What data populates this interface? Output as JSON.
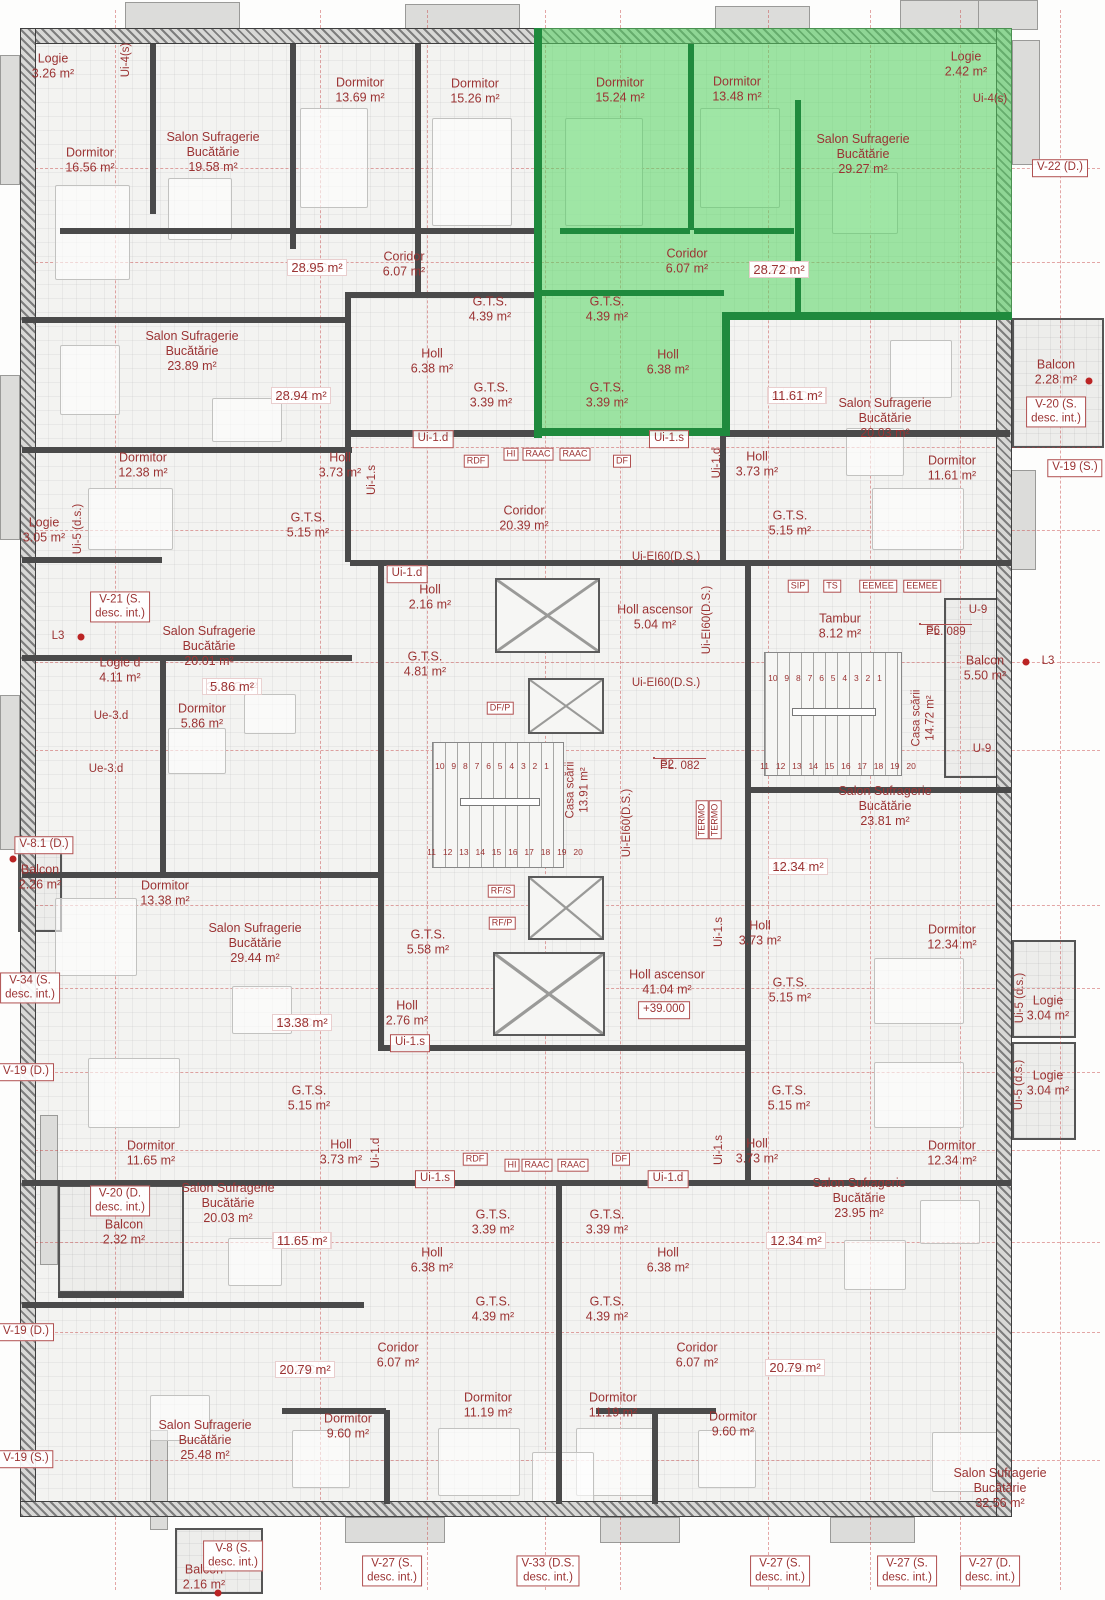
{
  "plan": {
    "highlighted_apartment": "Ap. 81",
    "level_mark": "+39.000",
    "colors": {
      "label_red": "#9b3333",
      "highlight_green": "#54d660",
      "wall_dark": "#4a4a4a",
      "green_wall": "#1f8a3d"
    }
  },
  "apartments": [
    {
      "id": "Ap. 80",
      "total": "72.02 m²",
      "type": "2-C",
      "area2": "28.95 m²",
      "x": 317,
      "y": 259
    },
    {
      "id": "Ap. 81",
      "total": "80.64 m²",
      "type": "2-C",
      "area2": "28.72 m²",
      "x": 779,
      "y": 261
    },
    {
      "id": "Ap. 82",
      "total": "41.20 m²",
      "type": "1-C",
      "area2": "11.61 m²",
      "x": 797,
      "y": 387
    },
    {
      "id": "Ap. 79",
      "total": "64.76 m²",
      "type": "2-C",
      "area2": "28.94 m²",
      "x": 301,
      "y": 387
    },
    {
      "id": "Ap. 78",
      "total": "34.89 m²",
      "type": "1-C",
      "area2": "5.86 m²",
      "x": 232,
      "y": 678
    },
    {
      "id": "Ap. 83",
      "total": "48.07 m²",
      "type": "1-C",
      "area2": "12.34 m²",
      "x": 798,
      "y": 858
    },
    {
      "id": "Ap. 88",
      "total": "51.83 m²",
      "type": "1-C",
      "area2": "13.38 m²",
      "x": 302,
      "y": 1014
    },
    {
      "id": "Ap. 87",
      "total": "41.25 m²",
      "type": "1-C",
      "area2": "11.65 m²",
      "x": 302,
      "y": 1232
    },
    {
      "id": "Ap. 84",
      "total": "48.21 m²",
      "type": "1-C",
      "area2": "12.34 m²",
      "x": 796,
      "y": 1232
    },
    {
      "id": "Ap. 86",
      "total": "67.15 m²",
      "type": "2-C",
      "area2": "20.79 m²",
      "x": 305,
      "y": 1361
    },
    {
      "id": "Ap. 85",
      "total": "73.58 m²",
      "type": "2-C",
      "area2": "20.79 m²",
      "x": 795,
      "y": 1359
    }
  ],
  "rooms": [
    {
      "t": [
        "Logie",
        "3.26 m²"
      ],
      "x": 53,
      "y": 66
    },
    {
      "t": [
        "Dormitor",
        "16.56 m²"
      ],
      "x": 90,
      "y": 160
    },
    {
      "t": [
        "Salon Sufragerie",
        "Bucătărie",
        "19.58 m²"
      ],
      "x": 213,
      "y": 152
    },
    {
      "t": [
        "Dormitor",
        "13.69 m²"
      ],
      "x": 360,
      "y": 90
    },
    {
      "t": [
        "Coridor",
        "6.07 m²"
      ],
      "x": 404,
      "y": 264
    },
    {
      "t": [
        "Dormitor",
        "15.26 m²"
      ],
      "x": 475,
      "y": 91
    },
    {
      "t": [
        "G.T.S.",
        "4.39 m²"
      ],
      "x": 490,
      "y": 309
    },
    {
      "t": [
        "Holl",
        "6.38 m²"
      ],
      "x": 432,
      "y": 361
    },
    {
      "t": [
        "G.T.S.",
        "3.39 m²"
      ],
      "x": 491,
      "y": 395
    },
    {
      "t": [
        "Dormitor",
        "15.24 m²"
      ],
      "x": 620,
      "y": 90
    },
    {
      "t": [
        "Dormitor",
        "13.48 m²"
      ],
      "x": 737,
      "y": 89
    },
    {
      "t": [
        "Logie",
        "2.42 m²"
      ],
      "x": 966,
      "y": 64
    },
    {
      "t": [
        "Salon Sufragerie",
        "Bucătărie",
        "29.27 m²"
      ],
      "x": 863,
      "y": 154
    },
    {
      "t": [
        "Coridor",
        "6.07 m²"
      ],
      "x": 687,
      "y": 261
    },
    {
      "t": [
        "G.T.S.",
        "4.39 m²"
      ],
      "x": 607,
      "y": 309
    },
    {
      "t": [
        "G.T.S.",
        "3.39 m²"
      ],
      "x": 607,
      "y": 395
    },
    {
      "t": [
        "Holl",
        "6.38 m²"
      ],
      "x": 668,
      "y": 362
    },
    {
      "t": [
        "Salon Sufragerie",
        "Bucătărie",
        "20.03 m²"
      ],
      "x": 885,
      "y": 418
    },
    {
      "t": [
        "Balcon",
        "2.28 m²"
      ],
      "x": 1056,
      "y": 372
    },
    {
      "t": [
        "Holl",
        "3.73 m²"
      ],
      "x": 757,
      "y": 464
    },
    {
      "t": [
        "Dormitor",
        "11.61 m²"
      ],
      "x": 952,
      "y": 468
    },
    {
      "t": [
        "G.T.S.",
        "5.15 m²"
      ],
      "x": 790,
      "y": 523
    },
    {
      "t": [
        "Salon Sufragerie",
        "Bucătărie",
        "23.89 m²"
      ],
      "x": 192,
      "y": 351
    },
    {
      "t": [
        "Dormitor",
        "12.38 m²"
      ],
      "x": 143,
      "y": 465
    },
    {
      "t": [
        "Holl",
        "3.73 m²"
      ],
      "x": 340,
      "y": 465
    },
    {
      "t": [
        "Logie",
        "3.05 m²"
      ],
      "x": 44,
      "y": 530
    },
    {
      "t": [
        "G.T.S.",
        "5.15 m²"
      ],
      "x": 308,
      "y": 525
    },
    {
      "t": [
        "Coridor",
        "20.39 m²"
      ],
      "x": 524,
      "y": 518
    },
    {
      "t": [
        "Holl ascensor",
        "5.04 m²"
      ],
      "x": 655,
      "y": 617
    },
    {
      "t": [
        "Holl",
        "2.16 m²"
      ],
      "x": 430,
      "y": 597
    },
    {
      "t": [
        "G.T.S.",
        "4.81 m²"
      ],
      "x": 425,
      "y": 664
    },
    {
      "t": [
        "Tambur",
        "8.12 m²"
      ],
      "x": 840,
      "y": 626
    },
    {
      "t": [
        "Balcon",
        "5.50 m²"
      ],
      "x": 985,
      "y": 668
    },
    {
      "t": [
        "Logie d",
        "4.11 m²"
      ],
      "x": 120,
      "y": 670
    },
    {
      "t": [
        "Salon Sufragerie",
        "Bucătărie",
        "20.01 m²"
      ],
      "x": 209,
      "y": 646
    },
    {
      "t": [
        "Dormitor",
        "5.86 m²"
      ],
      "x": 202,
      "y": 716
    },
    {
      "t": [
        "Balcon",
        "2.26 m²"
      ],
      "x": 40,
      "y": 877
    },
    {
      "t": [
        "Dormitor",
        "13.38 m²"
      ],
      "x": 165,
      "y": 893
    },
    {
      "t": [
        "Salon Sufragerie",
        "Bucătărie",
        "29.44 m²"
      ],
      "x": 255,
      "y": 943
    },
    {
      "t": [
        "Dormitor",
        "11.65 m²"
      ],
      "x": 151,
      "y": 1153
    },
    {
      "t": [
        "G.T.S.",
        "5.15 m²"
      ],
      "x": 309,
      "y": 1098
    },
    {
      "t": [
        "Holl",
        "3.73 m²"
      ],
      "x": 341,
      "y": 1152
    },
    {
      "t": [
        "G.T.S.",
        "5.58 m²"
      ],
      "x": 428,
      "y": 942
    },
    {
      "t": [
        "Holl",
        "2.76 m²"
      ],
      "x": 407,
      "y": 1013
    },
    {
      "t": [
        "Holl ascensor",
        "41.04 m²"
      ],
      "x": 667,
      "y": 982
    },
    {
      "t": [
        "Salon Sufragerie",
        "Bucătărie",
        "23.81 m²"
      ],
      "x": 885,
      "y": 806
    },
    {
      "t": [
        "Dormitor",
        "12.34 m²"
      ],
      "x": 952,
      "y": 937
    },
    {
      "t": [
        "Logie",
        "3.04 m²"
      ],
      "x": 1048,
      "y": 1008
    },
    {
      "t": [
        "Holl",
        "3.73 m²"
      ],
      "x": 760,
      "y": 933
    },
    {
      "t": [
        "G.T.S.",
        "5.15 m²"
      ],
      "x": 790,
      "y": 990
    },
    {
      "t": [
        "G.T.S.",
        "5.15 m²"
      ],
      "x": 789,
      "y": 1098
    },
    {
      "t": [
        "Holl",
        "3.73 m²"
      ],
      "x": 757,
      "y": 1151
    },
    {
      "t": [
        "Dormitor",
        "12.34 m²"
      ],
      "x": 952,
      "y": 1153
    },
    {
      "t": [
        "Logie",
        "3.04 m²"
      ],
      "x": 1048,
      "y": 1083
    },
    {
      "t": [
        "Salon Sufragerie",
        "Bucătărie",
        "23.95 m²"
      ],
      "x": 859,
      "y": 1198
    },
    {
      "t": [
        "Balcon",
        "2.32 m²"
      ],
      "x": 124,
      "y": 1232
    },
    {
      "t": [
        "Salon Sufragerie",
        "Bucătărie",
        "20.03 m²"
      ],
      "x": 228,
      "y": 1203
    },
    {
      "t": [
        "Salon Sufragerie",
        "Bucătărie",
        "25.48 m²"
      ],
      "x": 205,
      "y": 1440
    },
    {
      "t": [
        "Dormitor",
        "9.60 m²"
      ],
      "x": 348,
      "y": 1426
    },
    {
      "t": [
        "G.T.S.",
        "3.39 m²"
      ],
      "x": 493,
      "y": 1222
    },
    {
      "t": [
        "G.T.S.",
        "3.39 m²"
      ],
      "x": 607,
      "y": 1222
    },
    {
      "t": [
        "Holl",
        "6.38 m²"
      ],
      "x": 432,
      "y": 1260
    },
    {
      "t": [
        "Holl",
        "6.38 m²"
      ],
      "x": 668,
      "y": 1260
    },
    {
      "t": [
        "G.T.S.",
        "4.39 m²"
      ],
      "x": 493,
      "y": 1309
    },
    {
      "t": [
        "G.T.S.",
        "4.39 m²"
      ],
      "x": 607,
      "y": 1309
    },
    {
      "t": [
        "Coridor",
        "6.07 m²"
      ],
      "x": 398,
      "y": 1355
    },
    {
      "t": [
        "Coridor",
        "6.07 m²"
      ],
      "x": 697,
      "y": 1355
    },
    {
      "t": [
        "Dormitor",
        "11.19 m²"
      ],
      "x": 488,
      "y": 1405
    },
    {
      "t": [
        "Dormitor",
        "11.19 m²"
      ],
      "x": 613,
      "y": 1405
    },
    {
      "t": [
        "Dormitor",
        "9.60 m²"
      ],
      "x": 733,
      "y": 1424
    },
    {
      "t": [
        "Salon Sufragerie",
        "Bucătărie",
        "32.56 m²"
      ],
      "x": 1000,
      "y": 1488
    },
    {
      "t": [
        "Balcon",
        "2.16 m²"
      ],
      "x": 204,
      "y": 1577
    }
  ],
  "boxes": [
    {
      "t": [
        "V-22 (D.)"
      ],
      "x": 1060,
      "y": 168
    },
    {
      "t": [
        "V-20 (S.",
        "desc. int.)"
      ],
      "x": 1056,
      "y": 412
    },
    {
      "t": [
        "V-19 (S.)"
      ],
      "x": 1075,
      "y": 468
    },
    {
      "t": [
        "V-21 (S.",
        "desc. int.)"
      ],
      "x": 120,
      "y": 607
    },
    {
      "t": [
        "V-8.1 (D.)"
      ],
      "x": 44,
      "y": 845
    },
    {
      "t": [
        "V-34 (S.",
        "desc. int.)"
      ],
      "x": 30,
      "y": 988
    },
    {
      "t": [
        "V-19 (D.)"
      ],
      "x": 26,
      "y": 1072
    },
    {
      "t": [
        "V-20 (D.",
        "desc. int.)"
      ],
      "x": 120,
      "y": 1201
    },
    {
      "t": [
        "V-19 (D.)"
      ],
      "x": 26,
      "y": 1332
    },
    {
      "t": [
        "V-19 (S.)"
      ],
      "x": 26,
      "y": 1459
    },
    {
      "t": [
        "+39.000"
      ],
      "x": 664,
      "y": 1010
    },
    {
      "t": [
        "Ui-1.d"
      ],
      "x": 433,
      "y": 439
    },
    {
      "t": [
        "Ui-1.s"
      ],
      "x": 669,
      "y": 439
    },
    {
      "t": [
        "Ui-1.d"
      ],
      "x": 407,
      "y": 574
    },
    {
      "t": [
        "Ui-1.s"
      ],
      "x": 410,
      "y": 1043
    },
    {
      "t": [
        "Ui-1.s"
      ],
      "x": 435,
      "y": 1179
    },
    {
      "t": [
        "Ui-1.d"
      ],
      "x": 668,
      "y": 1179
    },
    {
      "t": [
        "V-8 (S.",
        "desc. int.)"
      ],
      "x": 233,
      "y": 1556
    },
    {
      "t": [
        "V-27 (S.",
        "desc. int.)"
      ],
      "x": 392,
      "y": 1571
    },
    {
      "t": [
        "V-33 (D.S.",
        "desc. int.)"
      ],
      "x": 548,
      "y": 1571
    },
    {
      "t": [
        "V-27 (S.",
        "desc. int.)"
      ],
      "x": 780,
      "y": 1571
    },
    {
      "t": [
        "V-27 (S.",
        "desc. int.)"
      ],
      "x": 907,
      "y": 1571
    },
    {
      "t": [
        "V-27 (D.",
        "desc. int.)"
      ],
      "x": 990,
      "y": 1571
    }
  ],
  "cellboxes": [
    {
      "t": [
        "E2",
        "PL. 082"
      ],
      "x": 654,
      "y": 758
    },
    {
      "t": [
        "E6",
        "PL. 089"
      ],
      "x": 920,
      "y": 624
    }
  ],
  "plain": [
    {
      "t": "Ui-4(s)",
      "x": 990,
      "y": 100
    },
    {
      "t": "Ui-EI60(D.S.)",
      "x": 666,
      "y": 558
    },
    {
      "t": "Ui-EI60(D.S.)",
      "x": 666,
      "y": 684
    },
    {
      "t": "U-9",
      "x": 978,
      "y": 611
    },
    {
      "t": "U-9",
      "x": 982,
      "y": 750
    },
    {
      "t": "L3",
      "x": 1048,
      "y": 662
    },
    {
      "t": "L3",
      "x": 58,
      "y": 637
    },
    {
      "t": "Ue-3.d",
      "x": 111,
      "y": 717
    },
    {
      "t": "Ue-3.d",
      "x": 106,
      "y": 770
    }
  ],
  "vertical": [
    {
      "t": [
        "Ui-4(s)"
      ],
      "x": 127,
      "y": 60
    },
    {
      "t": [
        "Ui-5 (d.s.)"
      ],
      "x": 79,
      "y": 529
    },
    {
      "t": [
        "Ui-1.s"
      ],
      "x": 373,
      "y": 480
    },
    {
      "t": [
        "Ui-1.d"
      ],
      "x": 718,
      "y": 463
    },
    {
      "t": [
        "Ui-EI60(D.S.)"
      ],
      "x": 708,
      "y": 620
    },
    {
      "t": [
        "Ui-EI60(D.S.)"
      ],
      "x": 628,
      "y": 823
    },
    {
      "t": [
        "Ui-1.d"
      ],
      "x": 377,
      "y": 1153
    },
    {
      "t": [
        "Ui-1.s"
      ],
      "x": 720,
      "y": 932
    },
    {
      "t": [
        "Ui-1.s"
      ],
      "x": 720,
      "y": 1150
    },
    {
      "t": [
        "Ui-5 (d.s.)"
      ],
      "x": 1021,
      "y": 998
    },
    {
      "t": [
        "Ui-5 (d.s.)"
      ],
      "x": 1020,
      "y": 1085
    },
    {
      "t": [
        "Casa scării",
        "13.91 m²"
      ],
      "x": 578,
      "y": 790
    },
    {
      "t": [
        "Casa scării",
        "14.72 m²"
      ],
      "x": 924,
      "y": 718
    }
  ],
  "vboxes": [
    {
      "t": "TERMO",
      "x": 702,
      "y": 820
    },
    {
      "t": "TERMO",
      "x": 715,
      "y": 820
    }
  ],
  "small": [
    {
      "t": "SIP",
      "x": 798,
      "y": 586
    },
    {
      "t": "TS",
      "x": 832,
      "y": 586
    },
    {
      "t": "EEMEE",
      "x": 878,
      "y": 586
    },
    {
      "t": "EEMEE",
      "x": 922,
      "y": 586
    },
    {
      "t": "RDF",
      "x": 476,
      "y": 461
    },
    {
      "t": "HI",
      "x": 511,
      "y": 454
    },
    {
      "t": "RAAC",
      "x": 538,
      "y": 454
    },
    {
      "t": "RAAC",
      "x": 575,
      "y": 454
    },
    {
      "t": "DF",
      "x": 622,
      "y": 461
    },
    {
      "t": "DF/P",
      "x": 500,
      "y": 708
    },
    {
      "t": "RF/S",
      "x": 501,
      "y": 891
    },
    {
      "t": "RF/P",
      "x": 502,
      "y": 923
    },
    {
      "t": "RDF",
      "x": 475,
      "y": 1159
    },
    {
      "t": "HI",
      "x": 512,
      "y": 1165
    },
    {
      "t": "RAAC",
      "x": 537,
      "y": 1165
    },
    {
      "t": "RAAC",
      "x": 573,
      "y": 1165
    },
    {
      "t": "DF",
      "x": 621,
      "y": 1159
    }
  ],
  "stair_numbers": [
    {
      "t": "10 9 8 7 6 5 4 3 2 1",
      "x": 492,
      "y": 766
    },
    {
      "t": "11 12 13 14 15 16 17 18 19 20",
      "x": 505,
      "y": 852
    },
    {
      "t": "10 9 8 7 6 5 4 3 2 1",
      "x": 825,
      "y": 678
    },
    {
      "t": "11 12 13 14 15 16 17 18 19 20",
      "x": 838,
      "y": 766
    }
  ]
}
